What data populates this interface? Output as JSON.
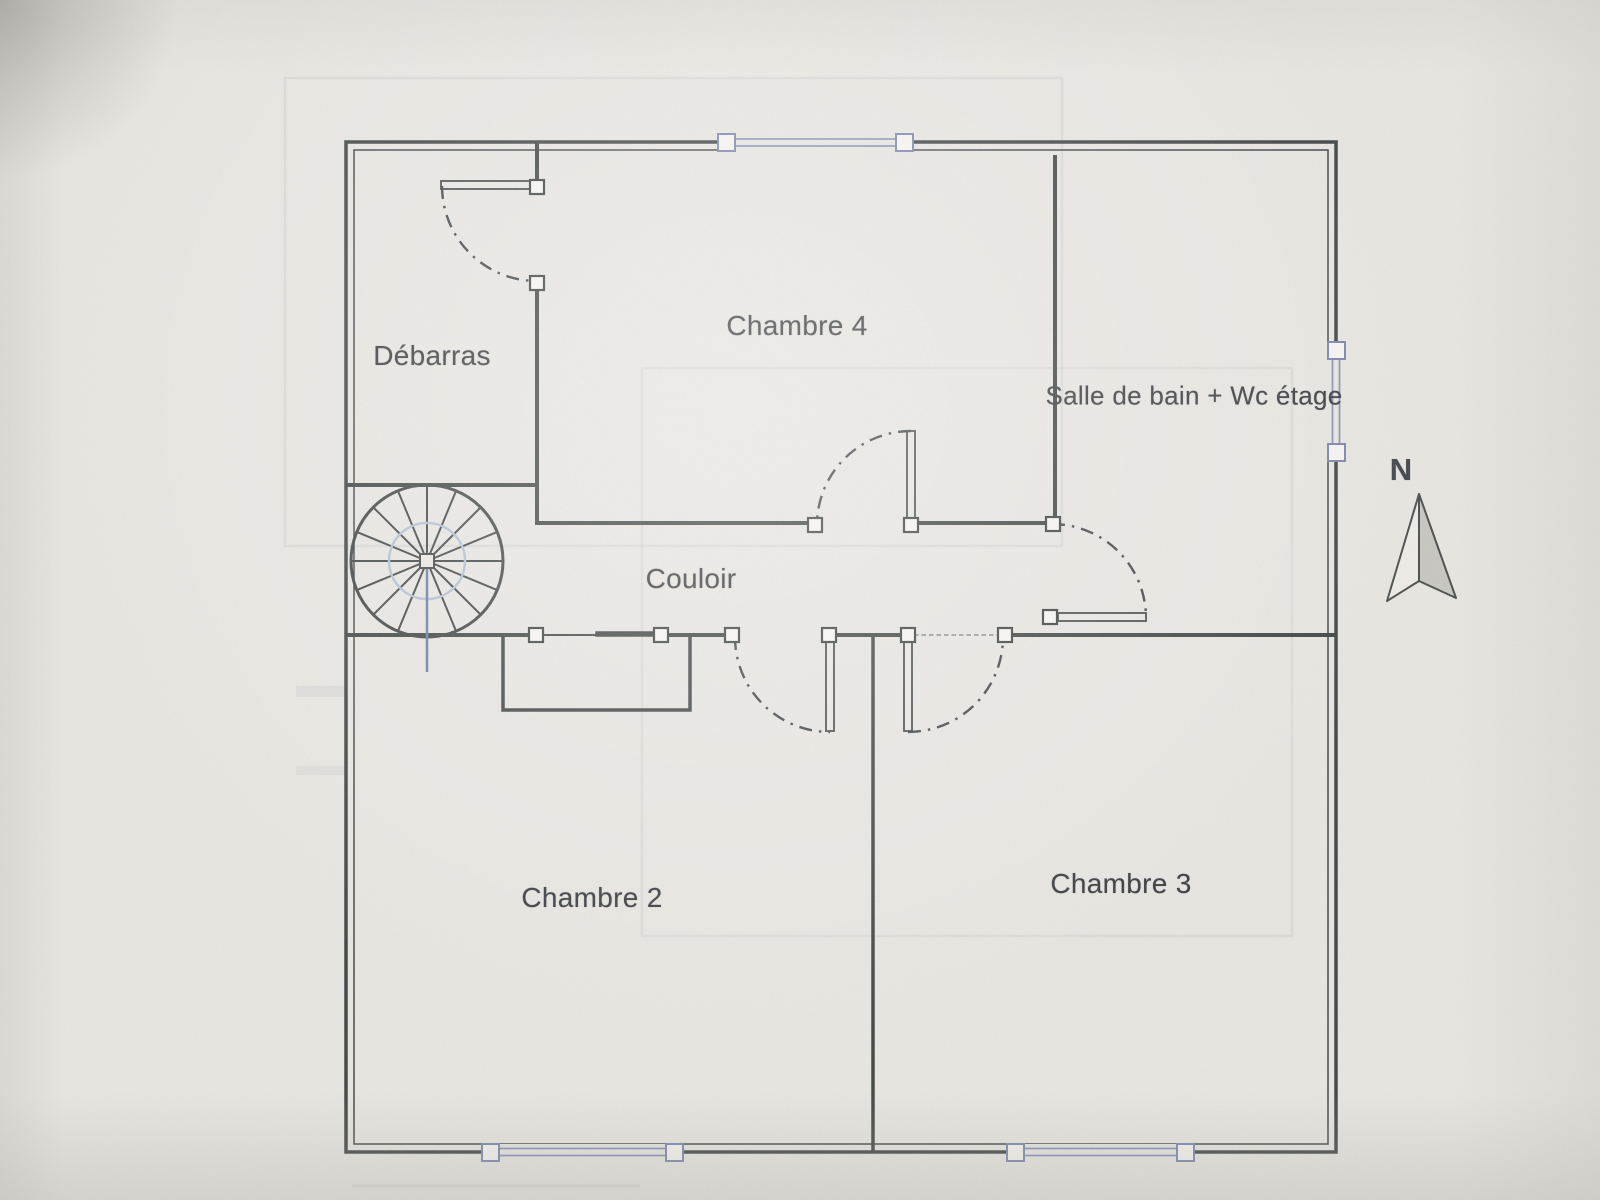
{
  "floor_plan": {
    "rooms": [
      {
        "name": "debarras",
        "label": "Débarras"
      },
      {
        "name": "chambre-4",
        "label": "Chambre 4"
      },
      {
        "name": "salle-de-bain-wc",
        "label": "Salle de bain + Wc étage"
      },
      {
        "name": "couloir",
        "label": "Couloir"
      },
      {
        "name": "chambre-2",
        "label": "Chambre 2"
      },
      {
        "name": "chambre-3",
        "label": "Chambre 3"
      }
    ],
    "compass": {
      "label": "N"
    },
    "symbols": {
      "spiral_staircase_count": 1,
      "swing_door_count": 5,
      "sliding_door_count": 1,
      "window_count": 4
    },
    "colors": {
      "paper": "#e7e5e0",
      "wall": "#434846",
      "window_blue": "#8b94b6",
      "stair_inner_circle": "#b3bfd4",
      "stair_axis_blue": "#687fae",
      "label_text": "#3c3f42",
      "north_arrow_fill": "#c7c6c1"
    }
  }
}
